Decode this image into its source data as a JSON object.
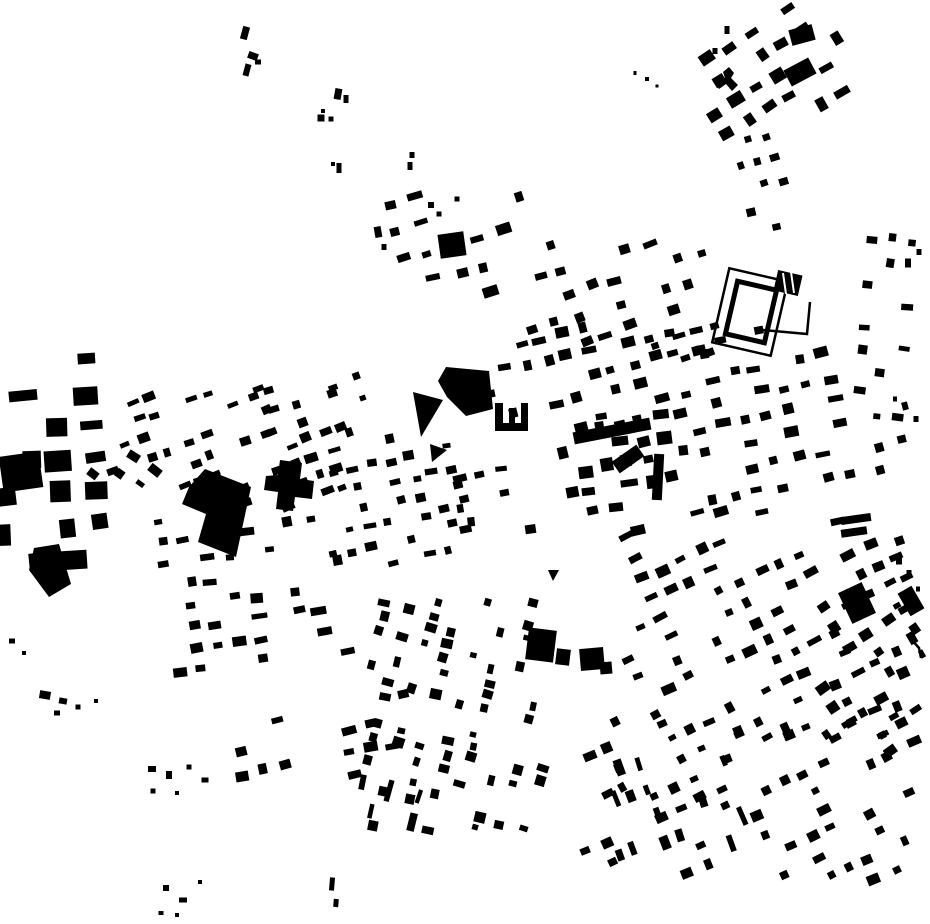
{
  "figure": {
    "width": 930,
    "height": 924,
    "background_color": "#ffffff",
    "building_color": "#000000"
  },
  "map": {
    "districts": [
      {
        "n": "tr-corner",
        "x": 705,
        "y": 5,
        "w": 140,
        "h": 140,
        "a": -32,
        "px": 24,
        "py": 24,
        "bw": 13,
        "bh": 10,
        "d": 0.6,
        "s": 11
      },
      {
        "n": "tr-tail",
        "x": 735,
        "y": 135,
        "w": 55,
        "h": 100,
        "a": -15,
        "px": 19,
        "py": 23,
        "bw": 9,
        "bh": 7,
        "d": 0.45,
        "s": 12
      },
      {
        "n": "top-mid-west",
        "x": 378,
        "y": 195,
        "w": 150,
        "h": 100,
        "a": -15,
        "px": 26,
        "py": 28,
        "bw": 12,
        "bh": 8,
        "d": 0.45,
        "s": 13
      },
      {
        "n": "top-mid-east",
        "x": 528,
        "y": 232,
        "w": 185,
        "h": 142,
        "a": -18,
        "px": 23,
        "py": 25,
        "bw": 11,
        "bh": 8,
        "d": 0.55,
        "s": 14
      },
      {
        "n": "north-core",
        "x": 490,
        "y": 328,
        "w": 205,
        "h": 88,
        "a": -13,
        "px": 21,
        "py": 22,
        "bw": 11,
        "bh": 8,
        "d": 0.68,
        "s": 15
      },
      {
        "n": "core",
        "x": 562,
        "y": 412,
        "w": 128,
        "h": 102,
        "a": -10,
        "px": 20,
        "py": 20,
        "bw": 13,
        "bh": 10,
        "d": 0.75,
        "s": 16
      },
      {
        "n": "east-district",
        "x": 692,
        "y": 350,
        "w": 158,
        "h": 178,
        "a": -12,
        "px": 23,
        "py": 24,
        "bw": 12,
        "bh": 8,
        "d": 0.58,
        "s": 17
      },
      {
        "n": "right-strip",
        "x": 855,
        "y": 225,
        "w": 62,
        "h": 205,
        "a": 5,
        "px": 20,
        "py": 22,
        "bw": 10,
        "bh": 7,
        "d": 0.5,
        "s": 18
      },
      {
        "n": "far-right-mid",
        "x": 848,
        "y": 438,
        "w": 82,
        "h": 112,
        "a": -15,
        "px": 24,
        "py": 24,
        "bw": 10,
        "bh": 7,
        "d": 0.42,
        "s": 19
      },
      {
        "n": "se-main",
        "x": 622,
        "y": 538,
        "w": 292,
        "h": 206,
        "a": -25,
        "px": 22,
        "py": 22,
        "bw": 11,
        "bh": 8,
        "d": 0.6,
        "s": 20
      },
      {
        "n": "se-lower",
        "x": 582,
        "y": 718,
        "w": 330,
        "h": 162,
        "a": -25,
        "px": 21,
        "py": 21,
        "bw": 10,
        "bh": 8,
        "d": 0.55,
        "s": 21
      },
      {
        "n": "se-rowhouse-bars",
        "x": 598,
        "y": 762,
        "w": 145,
        "h": 95,
        "a": -20,
        "px": 16,
        "py": 27,
        "bw": 7,
        "bh": 15,
        "d": 0.4,
        "s": 22
      },
      {
        "n": "se-east",
        "x": 822,
        "y": 598,
        "w": 100,
        "h": 168,
        "a": -32,
        "px": 22,
        "py": 22,
        "bw": 10,
        "bh": 8,
        "d": 0.5,
        "s": 23
      },
      {
        "n": "south-columns",
        "x": 368,
        "y": 598,
        "w": 175,
        "h": 235,
        "a": 15,
        "px": 24,
        "py": 13,
        "bw": 9,
        "bh": 8,
        "d": 0.5,
        "s": 24
      },
      {
        "n": "south-bars",
        "x": 362,
        "y": 745,
        "w": 58,
        "h": 92,
        "a": 15,
        "px": 14,
        "py": 27,
        "bw": 6,
        "bh": 17,
        "d": 0.45,
        "s": 25
      },
      {
        "n": "west-upper",
        "x": 112,
        "y": 388,
        "w": 235,
        "h": 120,
        "a": -20,
        "px": 19,
        "py": 19,
        "bw": 10,
        "bh": 7,
        "d": 0.55,
        "s": 26
      },
      {
        "n": "west-rows",
        "x": 158,
        "y": 518,
        "w": 195,
        "h": 155,
        "a": -8,
        "px": 21,
        "py": 22,
        "bw": 12,
        "bh": 8,
        "d": 0.55,
        "s": 27
      },
      {
        "n": "west-industrial",
        "x": 0,
        "y": 358,
        "w": 122,
        "h": 205,
        "a": -5,
        "px": 31,
        "py": 33,
        "bw": 20,
        "bh": 15,
        "d": 0.5,
        "j": 4,
        "sj": 0.45,
        "s": 28
      },
      {
        "n": "west-central",
        "x": 333,
        "y": 432,
        "w": 135,
        "h": 135,
        "a": -12,
        "px": 19,
        "py": 20,
        "bw": 10,
        "bh": 7,
        "d": 0.6,
        "s": 29
      },
      {
        "n": "center-south",
        "x": 428,
        "y": 452,
        "w": 115,
        "h": 85,
        "a": -10,
        "px": 20,
        "py": 22,
        "bw": 11,
        "bh": 7,
        "d": 0.55,
        "s": 30
      },
      {
        "n": "core-south-gap",
        "x": 630,
        "y": 498,
        "w": 95,
        "h": 45,
        "a": -15,
        "px": 21,
        "py": 20,
        "bw": 11,
        "bh": 8,
        "d": 0.5,
        "s": 31
      },
      {
        "n": "nw-approach",
        "x": 252,
        "y": 352,
        "w": 115,
        "h": 85,
        "a": -20,
        "px": 24,
        "py": 24,
        "bw": 9,
        "bh": 7,
        "d": 0.4,
        "s": 32
      },
      {
        "n": "west-road-fan",
        "x": 82,
        "y": 455,
        "w": 95,
        "h": 95,
        "a": 35,
        "px": 24,
        "py": 20,
        "bw": 10,
        "bh": 7,
        "d": 0.4,
        "s": 33
      },
      {
        "n": "stadium-south",
        "x": 678,
        "y": 322,
        "w": 85,
        "h": 38,
        "a": -12,
        "px": 20,
        "py": 18,
        "bw": 11,
        "bh": 8,
        "d": 0.55,
        "s": 34
      },
      {
        "n": "sw-rows",
        "x": 235,
        "y": 688,
        "w": 180,
        "h": 92,
        "a": -12,
        "px": 22,
        "py": 24,
        "bw": 11,
        "bh": 8,
        "d": 0.5,
        "s": 35
      }
    ],
    "scatter_buildings": [
      [
        245,
        33,
        7,
        13,
        15
      ],
      [
        253,
        56,
        10,
        7,
        20
      ],
      [
        258,
        62,
        6,
        5,
        0
      ],
      [
        247,
        70,
        6,
        12,
        15
      ],
      [
        338,
        94,
        7,
        11,
        10
      ],
      [
        346,
        99,
        5,
        8,
        0
      ],
      [
        323,
        111,
        4,
        4,
        0
      ],
      [
        321,
        118,
        7,
        7,
        0
      ],
      [
        331,
        119,
        5,
        5,
        0
      ],
      [
        333,
        164,
        4,
        4,
        0
      ],
      [
        339,
        168,
        5,
        10,
        0
      ],
      [
        412,
        155,
        5,
        6,
        0
      ],
      [
        410,
        166,
        5,
        8,
        0
      ],
      [
        378,
        232,
        7,
        11,
        -10
      ],
      [
        384,
        247,
        5,
        6,
        0
      ],
      [
        431,
        205,
        6,
        6,
        0
      ],
      [
        439,
        214,
        5,
        5,
        0
      ],
      [
        457,
        199,
        5,
        5,
        0
      ],
      [
        635,
        73,
        3,
        4,
        0
      ],
      [
        647,
        79,
        4,
        4,
        0
      ],
      [
        657,
        86,
        3,
        3,
        0
      ],
      [
        715,
        51,
        5,
        6,
        0
      ],
      [
        727,
        30,
        5,
        8,
        0
      ],
      [
        905,
        406,
        6,
        8,
        -15
      ],
      [
        916,
        419,
        5,
        6,
        0
      ],
      [
        895,
        399,
        4,
        5,
        0
      ],
      [
        908,
        263,
        6,
        9,
        0
      ],
      [
        919,
        252,
        5,
        6,
        0
      ],
      [
        912,
        638,
        8,
        12,
        -30
      ],
      [
        922,
        654,
        5,
        8,
        -30
      ],
      [
        899,
        561,
        6,
        7,
        0
      ],
      [
        909,
        573,
        5,
        6,
        0
      ],
      [
        918,
        589,
        4,
        5,
        0
      ],
      [
        45,
        695,
        11,
        8,
        10
      ],
      [
        63,
        701,
        8,
        6,
        10
      ],
      [
        57,
        713,
        6,
        5,
        0
      ],
      [
        78,
        707,
        5,
        5,
        0
      ],
      [
        96,
        701,
        4,
        4,
        0
      ],
      [
        152,
        769,
        8,
        6,
        0
      ],
      [
        169,
        775,
        6,
        8,
        0
      ],
      [
        189,
        767,
        5,
        5,
        0
      ],
      [
        205,
        780,
        7,
        5,
        0
      ],
      [
        153,
        791,
        5,
        5,
        0
      ],
      [
        177,
        793,
        4,
        4,
        0
      ],
      [
        332,
        884,
        5,
        13,
        5
      ],
      [
        336,
        903,
        5,
        8,
        5
      ],
      [
        166,
        888,
        6,
        6,
        0
      ],
      [
        183,
        900,
        8,
        5,
        0
      ],
      [
        200,
        882,
        4,
        4,
        0
      ],
      [
        161,
        913,
        5,
        4,
        0
      ],
      [
        177,
        915,
        4,
        4,
        0
      ],
      [
        12,
        641,
        6,
        5,
        0
      ],
      [
        24,
        653,
        4,
        4,
        0
      ]
    ],
    "landmarks": [
      {
        "n": "bullring-outer-wall",
        "t": "routline",
        "cx": 750,
        "cy": 312,
        "w": 60,
        "h": 76,
        "a": 13,
        "sw": 2.5
      },
      {
        "n": "bullring-inner-ring",
        "t": "routline",
        "cx": 751,
        "cy": 312,
        "w": 40,
        "h": 54,
        "a": 13,
        "sw": 5
      },
      {
        "n": "striped-hall",
        "t": "rect",
        "cx": 788,
        "cy": 283,
        "w": 25,
        "h": 21,
        "a": 13
      },
      {
        "n": "striped-hall-gap-1",
        "t": "line",
        "pts": [
          [
            783,
            273
          ],
          [
            786,
            294
          ]
        ],
        "sw": 2,
        "c": "#ffffff"
      },
      {
        "n": "striped-hall-gap-2",
        "t": "line",
        "pts": [
          [
            791,
            272
          ],
          [
            794,
            293
          ]
        ],
        "sw": 2,
        "c": "#ffffff"
      },
      {
        "n": "bullring-yard-wall",
        "t": "line",
        "pts": [
          [
            810,
            302
          ],
          [
            807,
            334
          ],
          [
            763,
            330
          ]
        ],
        "sw": 2.5
      },
      {
        "n": "central-hall-block",
        "t": "poly",
        "pts": [
          [
            446,
            367
          ],
          [
            489,
            371
          ],
          [
            493,
            409
          ],
          [
            466,
            416
          ],
          [
            447,
            397
          ],
          [
            438,
            381
          ]
        ]
      },
      {
        "n": "u-shaped-building",
        "t": "poly",
        "pts": [
          [
            495,
            403
          ],
          [
            503,
            403
          ],
          [
            503,
            423
          ],
          [
            509,
            423
          ],
          [
            509,
            408
          ],
          [
            515,
            408
          ],
          [
            515,
            423
          ],
          [
            521,
            423
          ],
          [
            521,
            403
          ],
          [
            528,
            403
          ],
          [
            528,
            431
          ],
          [
            495,
            431
          ]
        ]
      },
      {
        "n": "wedge-building-1",
        "t": "poly",
        "pts": [
          [
            413,
            392
          ],
          [
            443,
            400
          ],
          [
            421,
            437
          ]
        ]
      },
      {
        "n": "wedge-building-2",
        "t": "poly",
        "pts": [
          [
            430,
            444
          ],
          [
            447,
            450
          ],
          [
            432,
            462
          ]
        ]
      },
      {
        "n": "factory-l-building",
        "t": "poly",
        "pts": [
          [
            205,
            469
          ],
          [
            251,
            487
          ],
          [
            236,
            557
          ],
          [
            198,
            542
          ],
          [
            206,
            514
          ],
          [
            182,
            504
          ],
          [
            189,
            487
          ]
        ]
      },
      {
        "n": "cross-building",
        "t": "poly",
        "pts": [
          [
            280,
            460
          ],
          [
            302,
            463
          ],
          [
            300,
            479
          ],
          [
            314,
            481
          ],
          [
            312,
            499
          ],
          [
            295,
            497
          ],
          [
            293,
            511
          ],
          [
            276,
            509
          ],
          [
            278,
            492
          ],
          [
            264,
            490
          ],
          [
            266,
            476
          ],
          [
            278,
            475
          ]
        ]
      },
      {
        "n": "west-dark-streak",
        "t": "poly",
        "pts": [
          [
            34,
            548
          ],
          [
            59,
            544
          ],
          [
            71,
            584
          ],
          [
            49,
            597
          ],
          [
            29,
            570
          ]
        ]
      },
      {
        "n": "west-corner-block",
        "t": "rect",
        "cx": 21,
        "cy": 472,
        "w": 40,
        "h": 36,
        "a": -8
      },
      {
        "n": "y-building",
        "t": "poly",
        "pts": [
          [
            723,
            72
          ],
          [
            729,
            67
          ],
          [
            734,
            73
          ],
          [
            731,
            78
          ],
          [
            738,
            85
          ],
          [
            732,
            91
          ],
          [
            726,
            84
          ],
          [
            719,
            89
          ],
          [
            715,
            83
          ],
          [
            725,
            78
          ]
        ]
      },
      {
        "n": "se-dark-block-1",
        "t": "rect",
        "cx": 857,
        "cy": 603,
        "w": 26,
        "h": 34,
        "a": -25
      },
      {
        "n": "se-dark-block-2",
        "t": "rect",
        "cx": 911,
        "cy": 601,
        "w": 16,
        "h": 26,
        "a": -30
      },
      {
        "n": "south-block-1",
        "t": "rect",
        "cx": 541,
        "cy": 645,
        "w": 28,
        "h": 32,
        "a": 7
      },
      {
        "n": "south-block-1b",
        "t": "rect",
        "cx": 563,
        "cy": 657,
        "w": 14,
        "h": 16,
        "a": 7
      },
      {
        "n": "south-block-2",
        "t": "rect",
        "cx": 592,
        "cy": 659,
        "w": 24,
        "h": 22,
        "a": -5
      },
      {
        "n": "south-block-2b",
        "t": "rect",
        "cx": 606,
        "cy": 668,
        "w": 12,
        "h": 12,
        "a": -5
      },
      {
        "n": "north-square-block",
        "t": "rect",
        "cx": 452,
        "cy": 245,
        "w": 26,
        "h": 24,
        "a": -8
      },
      {
        "n": "ne-large-block-1",
        "t": "rect",
        "cx": 802,
        "cy": 35,
        "w": 24,
        "h": 16,
        "a": -15
      },
      {
        "n": "ne-large-block-2",
        "t": "rect",
        "cx": 800,
        "cy": 72,
        "w": 28,
        "h": 18,
        "a": -28
      },
      {
        "n": "plaza-triangle-mark",
        "t": "poly",
        "pts": [
          [
            548,
            570
          ],
          [
            559,
            570
          ],
          [
            553,
            581
          ]
        ]
      },
      {
        "n": "core-long-bar",
        "t": "rect",
        "cx": 612,
        "cy": 431,
        "w": 78,
        "h": 12,
        "a": -11
      },
      {
        "n": "core-vertical-bar",
        "t": "rect",
        "cx": 658,
        "cy": 477,
        "w": 10,
        "h": 46,
        "a": 3
      },
      {
        "n": "core-diagonal-bar",
        "t": "rect",
        "cx": 628,
        "cy": 459,
        "w": 30,
        "h": 14,
        "a": -35
      },
      {
        "n": "east-bar-1",
        "t": "rect",
        "cx": 856,
        "cy": 519,
        "w": 30,
        "h": 8,
        "a": -8
      },
      {
        "n": "east-bar-2",
        "t": "rect",
        "cx": 854,
        "cy": 532,
        "w": 26,
        "h": 8,
        "a": -8
      },
      {
        "n": "se-curve-wall",
        "t": "line",
        "pts": [
          [
            912,
            640
          ],
          [
            919,
            648
          ],
          [
            921,
            658
          ]
        ],
        "sw": 2.5
      }
    ]
  }
}
